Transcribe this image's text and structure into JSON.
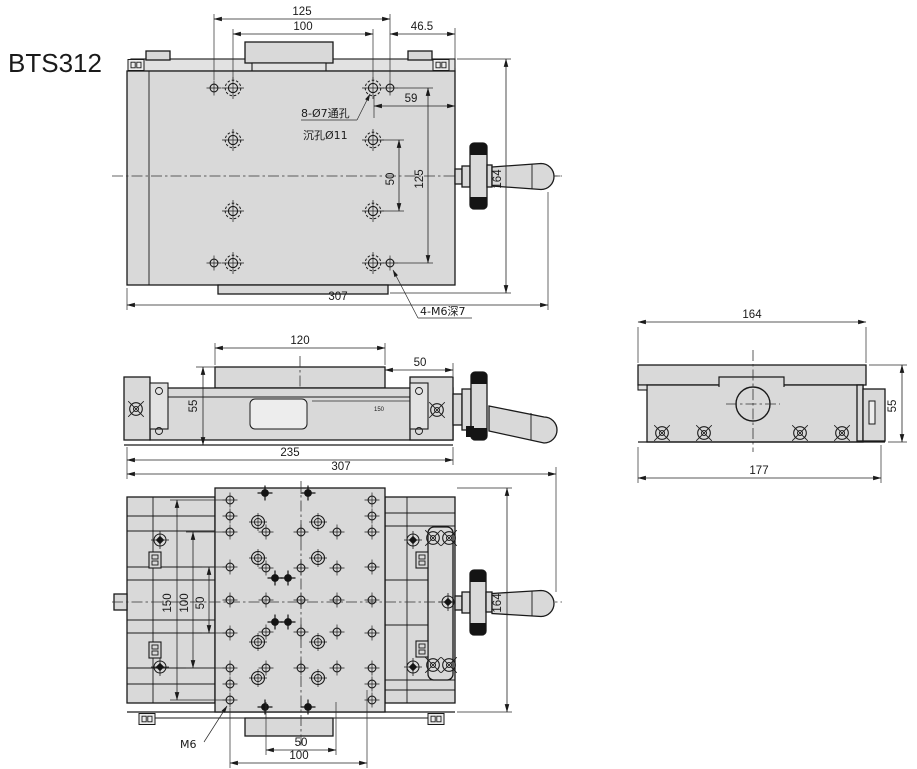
{
  "title": "BTS312",
  "colors": {
    "accent": "#3b4ec5",
    "body_fill": "#d9d9d9",
    "line": "#1a1a1a"
  },
  "top_view": {
    "dims": {
      "hole_span_w": "125",
      "hole_pitch_w": "100",
      "edge_offset": "46.5",
      "offset_59": "59",
      "hole_pitch_v": "50",
      "hole_span_v": "125",
      "depth": "164",
      "total_width": "307"
    },
    "notes": {
      "through_holes_1": "8-Ø7通孔",
      "through_holes_2": "沉孔Ø11",
      "tapped_holes": "4-M6深7"
    }
  },
  "side_view": {
    "dims": {
      "platform_length": "120",
      "handle_length": "50",
      "height": "55",
      "base_length": "235"
    },
    "scale": {
      "zero": "0",
      "max": "150"
    }
  },
  "bottom_view": {
    "dims": {
      "span_150": "150",
      "span_100": "100",
      "span_50": "50",
      "depth": "164",
      "pitch_50": "50",
      "pitch_100": "100",
      "total_width": "307"
    },
    "notes": {
      "thread": "M6"
    }
  },
  "end_view": {
    "dims": {
      "width": "164",
      "height": "55",
      "total_width": "177"
    }
  }
}
